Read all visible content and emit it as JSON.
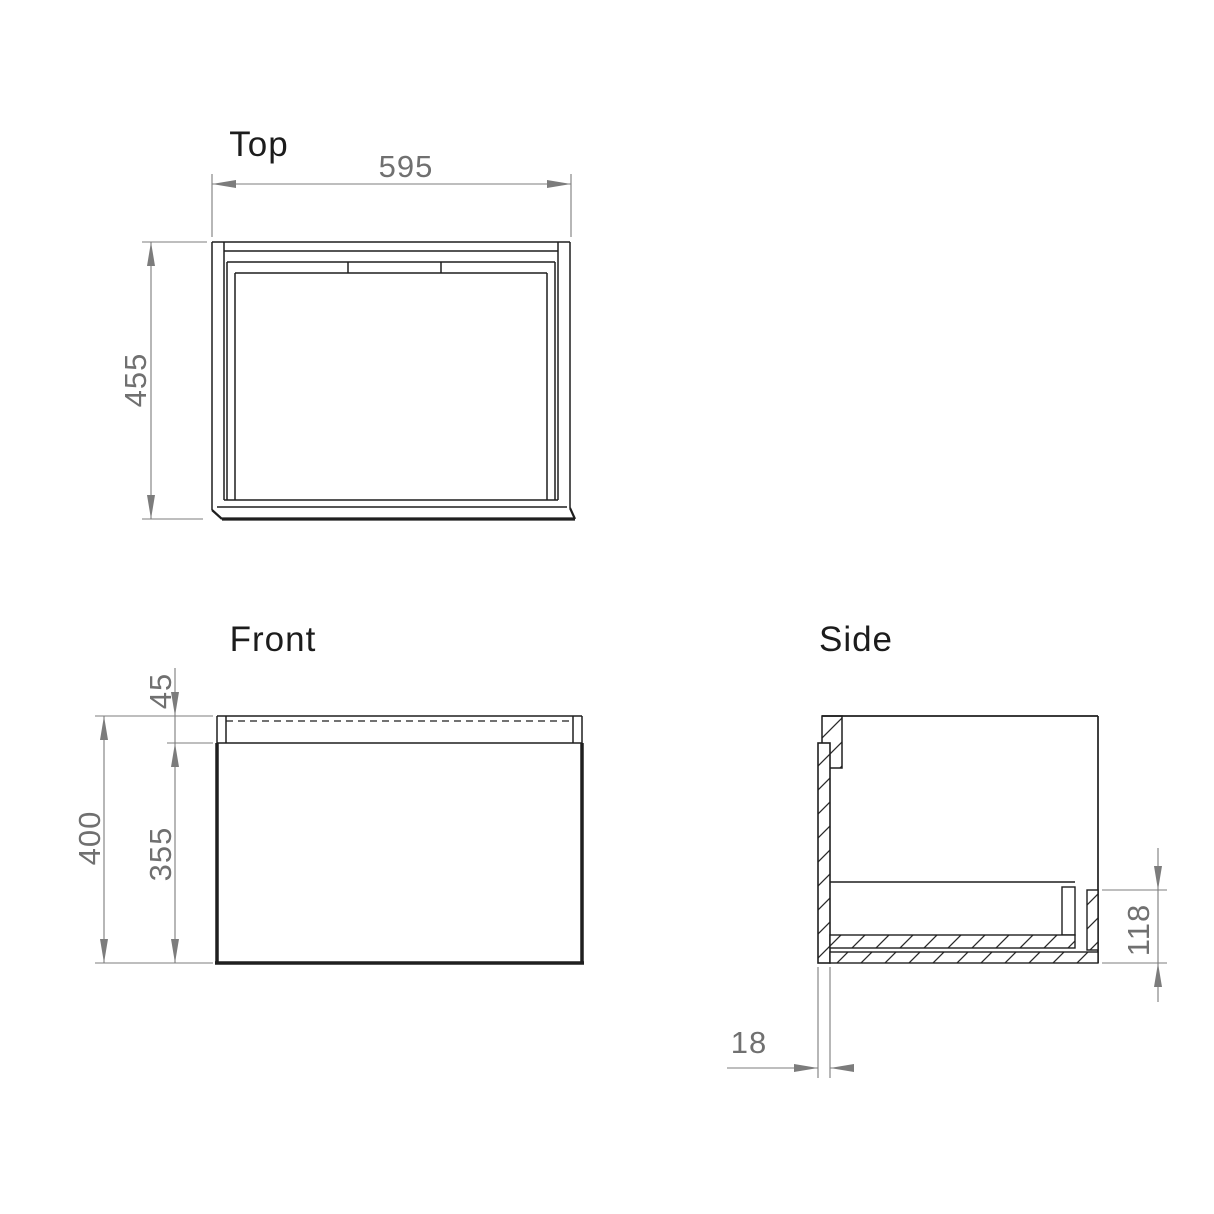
{
  "drawing": {
    "views": {
      "top": {
        "label": "Top",
        "width_dim": "595",
        "depth_dim": "455"
      },
      "front": {
        "label": "Front",
        "total_height_dim": "400",
        "top_rail_dim": "45",
        "drawer_front_dim": "355"
      },
      "side": {
        "label": "Side",
        "bottom_section_dim": "118",
        "panel_thickness_dim": "18"
      }
    },
    "colors": {
      "line": "#1f1f1f",
      "thick_line": "#141414",
      "dim_line": "#7c7c7c",
      "dim_text": "#707070",
      "label_text": "#1c1c1c",
      "hatch": "#2a2a2a",
      "background": "#ffffff"
    }
  }
}
